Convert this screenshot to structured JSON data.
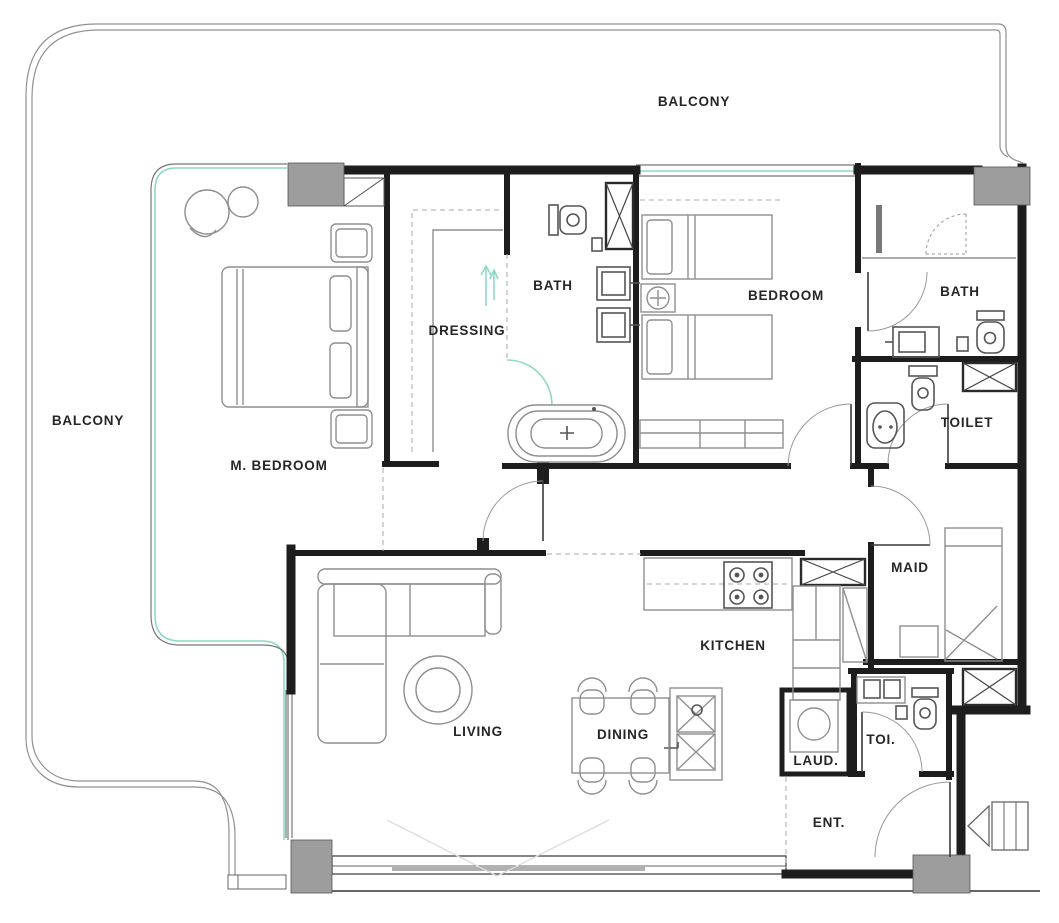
{
  "title": "Apartment floor plan",
  "colors": {
    "wall": "#1d1d1d",
    "furniture": "#8f8f8f",
    "furniture_dark": "#555555",
    "glass": "#8fd9c6",
    "column": "#9d9d9d",
    "railing": "#909090",
    "label": "#262626",
    "dashed": "#aaaaaa",
    "background": "#ffffff"
  },
  "rooms": [
    {
      "id": "balcony-top",
      "label": "BALCONY"
    },
    {
      "id": "balcony-left",
      "label": "BALCONY"
    },
    {
      "id": "master-bedroom",
      "label": "M. BEDROOM"
    },
    {
      "id": "dressing",
      "label": "DRESSING"
    },
    {
      "id": "master-bath",
      "label": "BATH"
    },
    {
      "id": "bedroom",
      "label": "BEDROOM"
    },
    {
      "id": "bath-2",
      "label": "BATH"
    },
    {
      "id": "toilet",
      "label": "TOILET"
    },
    {
      "id": "maid",
      "label": "MAID"
    },
    {
      "id": "kitchen",
      "label": "KITCHEN"
    },
    {
      "id": "living",
      "label": "LIVING"
    },
    {
      "id": "dining",
      "label": "DINING"
    },
    {
      "id": "laundry",
      "label": "LAUD."
    },
    {
      "id": "toi",
      "label": "TOI."
    },
    {
      "id": "entrance",
      "label": "ENT."
    }
  ]
}
